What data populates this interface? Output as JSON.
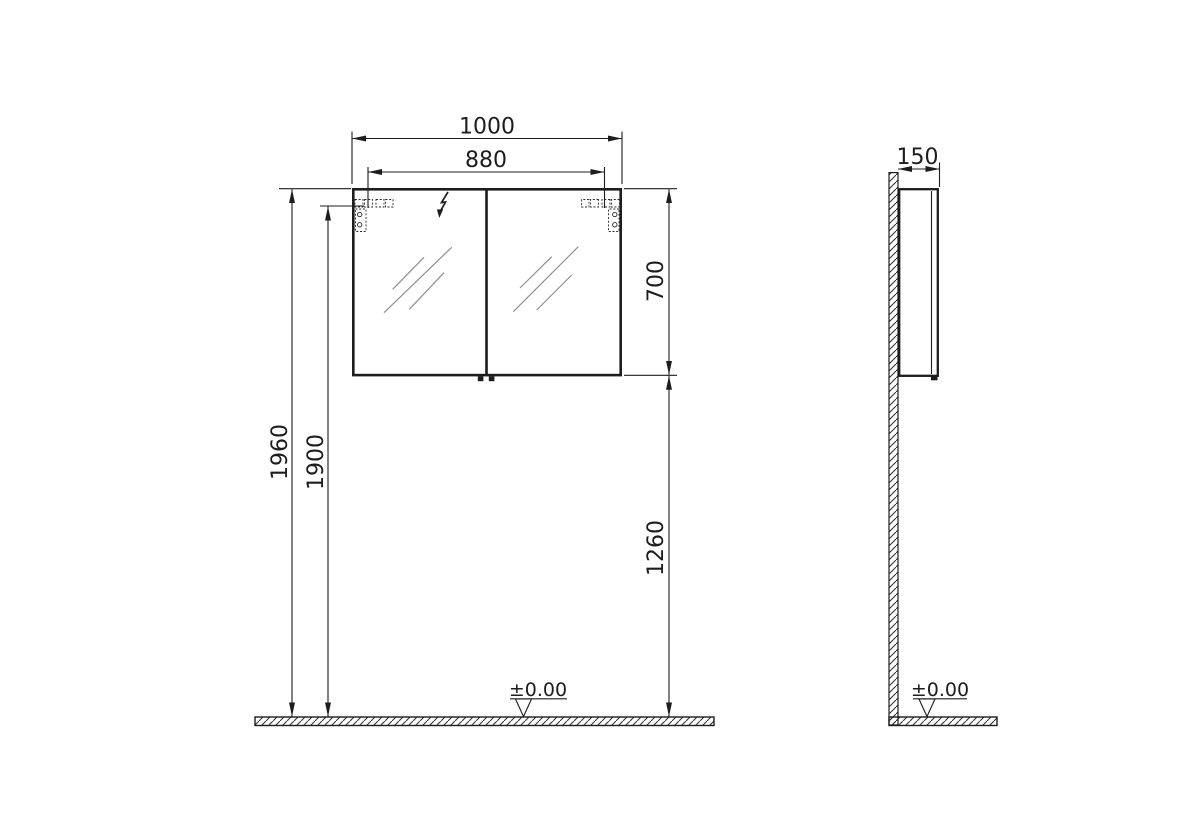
{
  "colors": {
    "line": "#1d1d1d",
    "mirror_hatch": "#8f8f8f",
    "background": "#ffffff"
  },
  "front_view": {
    "dimensions": {
      "overall_width": "1000",
      "fixing_hole_spacing": "880",
      "cabinet_height": "700",
      "overall_height": "1960",
      "fixing_height": "1900",
      "underside_height": "1260"
    },
    "floor_level_label": "±0.00"
  },
  "side_view": {
    "dimensions": {
      "depth": "150"
    },
    "floor_level_label": "±0.00"
  },
  "symbols": {
    "electrical_connection": "lightning-bolt-icon",
    "mounting_bracket": "dashed-wall-bracket",
    "floor_level": "level-datum-triangle"
  }
}
